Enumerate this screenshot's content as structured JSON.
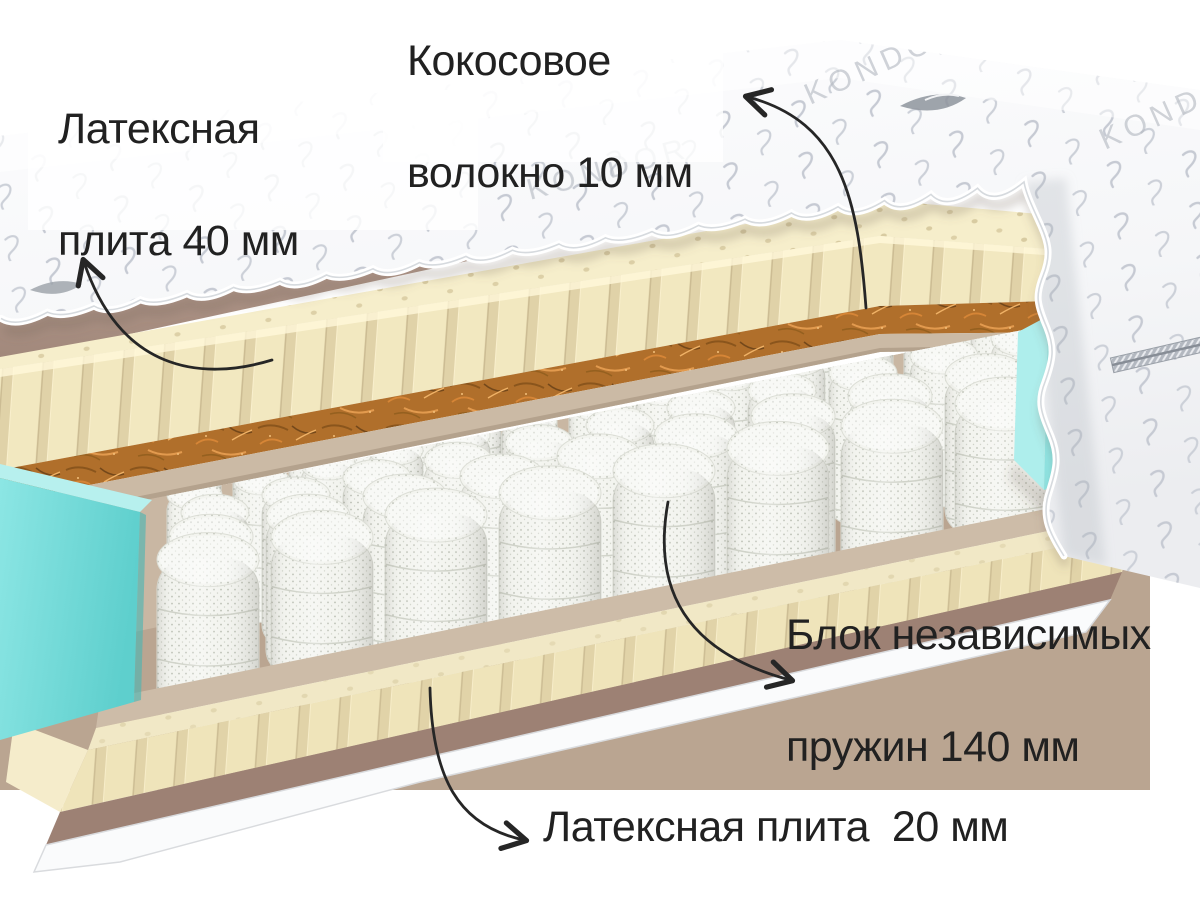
{
  "scene": {
    "type": "mattress-cutaway-diagram",
    "background_color": "#ffffff",
    "annotation_color": "#262626"
  },
  "brand": {
    "logo_text": "KONDOR"
  },
  "labels": {
    "latex_top": {
      "line1": "Латексная",
      "line2": "плита 40 мм"
    },
    "coconut": {
      "line1": "Кокосовое",
      "line2": "волокно 10 мм"
    },
    "springs": {
      "line1": "Блок независимых",
      "line2": "пружин 140 мм"
    },
    "latex_bottom": {
      "line1": "Латексная плита  20 мм"
    }
  },
  "layers": [
    {
      "name": "quilted-cover",
      "color": "#f6f7f9"
    },
    {
      "name": "felt-layer",
      "color": "#b29788"
    },
    {
      "name": "latex-plate-40mm",
      "color": "#f2e9c4"
    },
    {
      "name": "coconut-coir-10mm",
      "color": "#b06f2b"
    },
    {
      "name": "fiber-board",
      "color": "#cbbaa5"
    },
    {
      "name": "pocket-spring-block-140mm",
      "color": "#f3f4ef"
    },
    {
      "name": "side-support-foam",
      "color": "#7cdedd"
    },
    {
      "name": "latex-plate-20mm",
      "color": "#f1e8c6"
    },
    {
      "name": "bottom-felt",
      "color": "#9d8174"
    },
    {
      "name": "bottom-cover",
      "color": "#fafbfc"
    }
  ]
}
